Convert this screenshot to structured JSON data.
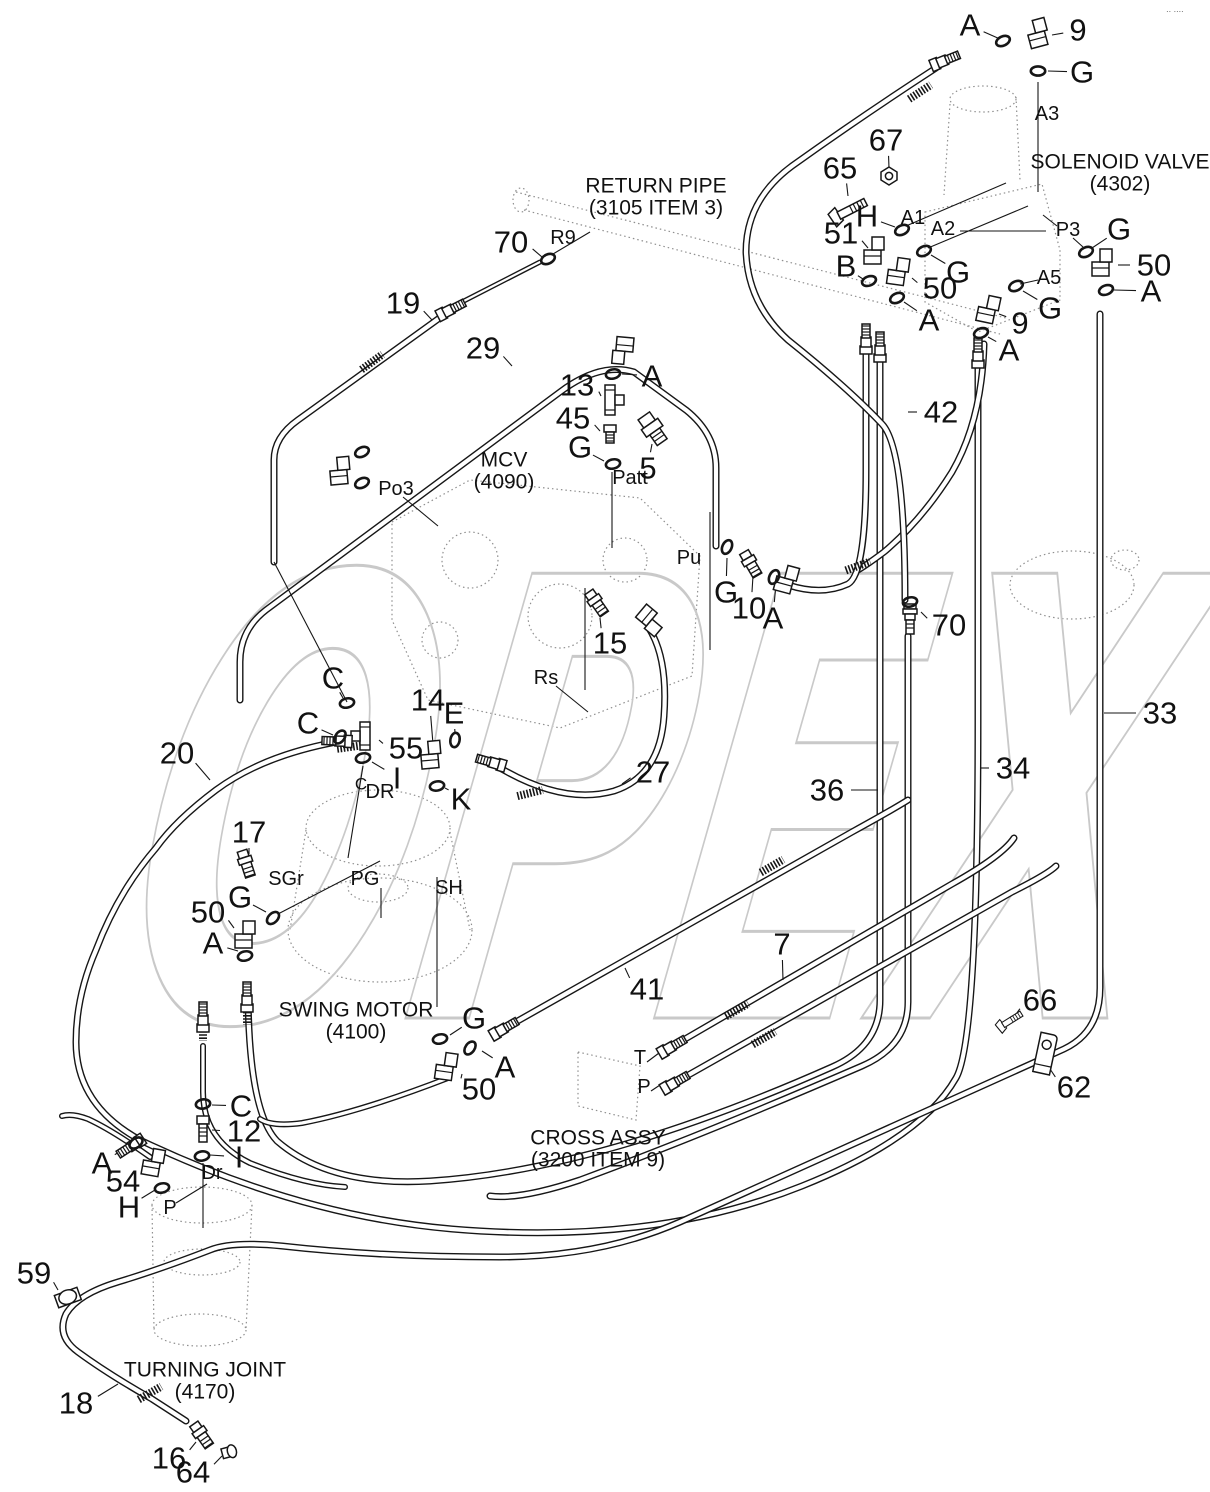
{
  "watermark": {
    "text": "OPEX",
    "color": "#c9c9c9"
  },
  "corner_mark": "∙∙ ∙∙∙∙",
  "colors": {
    "line": "#161616",
    "label": "#111111",
    "ghost": "#8f8f8f",
    "white": "#ffffff"
  },
  "titles": [
    {
      "id": "return-pipe",
      "lines": [
        "RETURN PIPE",
        "(3105 ITEM 3)"
      ],
      "x": 656,
      "y": 186
    },
    {
      "id": "solenoid-valve",
      "lines": [
        "SOLENOID VALVE",
        "(4302)"
      ],
      "x": 1120,
      "y": 162
    },
    {
      "id": "mcv",
      "lines": [
        "MCV",
        "(4090)"
      ],
      "x": 504,
      "y": 460
    },
    {
      "id": "swing-motor",
      "lines": [
        "SWING MOTOR",
        "(4100)"
      ],
      "x": 356,
      "y": 1010
    },
    {
      "id": "cross-assy",
      "lines": [
        "CROSS ASSY",
        "(3200 ITEM 9)"
      ],
      "x": 598,
      "y": 1138
    },
    {
      "id": "turning-joint",
      "lines": [
        "TURNING JOINT",
        "(4170)"
      ],
      "x": 205,
      "y": 1370
    }
  ],
  "callouts": [
    {
      "t": "A",
      "x": 970,
      "y": 25,
      "ex": 1000,
      "ey": 39
    },
    {
      "t": "9",
      "x": 1078,
      "y": 30,
      "ex": 1052,
      "ey": 35
    },
    {
      "t": "G",
      "x": 1082,
      "y": 72,
      "ex": 1048,
      "ey": 71
    },
    {
      "t": "67",
      "x": 886,
      "y": 140,
      "ex": 889,
      "ey": 168
    },
    {
      "t": "65",
      "x": 840,
      "y": 168,
      "ex": 848,
      "ey": 196
    },
    {
      "t": "H",
      "x": 867,
      "y": 216,
      "ex": 895,
      "ey": 227
    },
    {
      "t": "51",
      "x": 841,
      "y": 233,
      "ex": 868,
      "ey": 248
    },
    {
      "t": "B",
      "x": 846,
      "y": 266,
      "ex": 863,
      "ey": 279
    },
    {
      "t": "50",
      "x": 940,
      "y": 288,
      "ex": 912,
      "ey": 278
    },
    {
      "t": "G",
      "x": 958,
      "y": 272,
      "ex": 931,
      "ey": 255
    },
    {
      "t": "A",
      "x": 929,
      "y": 320,
      "ex": 904,
      "ey": 302
    },
    {
      "t": "9",
      "x": 1020,
      "y": 323,
      "ex": 999,
      "ey": 314
    },
    {
      "t": "G",
      "x": 1050,
      "y": 308,
      "ex": 1023,
      "ey": 291
    },
    {
      "t": "A",
      "x": 1009,
      "y": 350,
      "ex": 988,
      "ey": 337
    },
    {
      "t": "G",
      "x": 1119,
      "y": 229,
      "ex": 1092,
      "ey": 248
    },
    {
      "t": "50",
      "x": 1154,
      "y": 265,
      "ex": 1118,
      "ey": 265
    },
    {
      "t": "A",
      "x": 1151,
      "y": 291,
      "ex": 1114,
      "ey": 290
    },
    {
      "t": "70",
      "x": 511,
      "y": 242,
      "ex": 542,
      "ey": 257
    },
    {
      "t": "19",
      "x": 403,
      "y": 303,
      "ex": 432,
      "ey": 320
    },
    {
      "t": "29",
      "x": 483,
      "y": 348,
      "ex": 512,
      "ey": 366
    },
    {
      "t": "A",
      "x": 652,
      "y": 376,
      "ex": 622,
      "ey": 374
    },
    {
      "t": "13",
      "x": 577,
      "y": 385,
      "ex": 601,
      "ey": 396
    },
    {
      "t": "45",
      "x": 573,
      "y": 418,
      "ex": 600,
      "ey": 431
    },
    {
      "t": "G",
      "x": 580,
      "y": 447,
      "ex": 604,
      "ey": 461
    },
    {
      "t": "5",
      "x": 648,
      "y": 468,
      "ex": 652,
      "ey": 444
    },
    {
      "t": "15",
      "x": 610,
      "y": 643,
      "ex": 600,
      "ey": 618
    },
    {
      "t": "G",
      "x": 726,
      "y": 592,
      "ex": 727,
      "ey": 558
    },
    {
      "t": "10",
      "x": 749,
      "y": 608,
      "ex": 753,
      "ey": 576
    },
    {
      "t": "A",
      "x": 773,
      "y": 618,
      "ex": 776,
      "ey": 584
    },
    {
      "t": "70",
      "x": 949,
      "y": 625,
      "ex": 921,
      "ey": 612
    },
    {
      "t": "42",
      "x": 941,
      "y": 412,
      "ex": 908,
      "ey": 412
    },
    {
      "t": "33",
      "x": 1160,
      "y": 713,
      "ex": 1104,
      "ey": 713
    },
    {
      "t": "34",
      "x": 1013,
      "y": 768,
      "ex": 980,
      "ey": 768
    },
    {
      "t": "36",
      "x": 827,
      "y": 790,
      "ex": 878,
      "ey": 790
    },
    {
      "t": "C",
      "x": 333,
      "y": 678,
      "ex": 343,
      "ey": 698
    },
    {
      "t": "C",
      "x": 308,
      "y": 723,
      "ex": 333,
      "ey": 735
    },
    {
      "t": "20",
      "x": 177,
      "y": 753,
      "ex": 210,
      "ey": 780
    },
    {
      "t": "55",
      "x": 406,
      "y": 748,
      "ex": 379,
      "ey": 740
    },
    {
      "t": "14",
      "x": 428,
      "y": 700,
      "ex": 433,
      "ey": 744
    },
    {
      "t": "E",
      "x": 454,
      "y": 713,
      "ex": 455,
      "ey": 733
    },
    {
      "t": "I",
      "x": 397,
      "y": 778,
      "ex": 372,
      "ey": 762
    },
    {
      "t": "K",
      "x": 461,
      "y": 799,
      "ex": 445,
      "ey": 788
    },
    {
      "t": "27",
      "x": 653,
      "y": 772,
      "ex": 622,
      "ey": 784
    },
    {
      "t": "17",
      "x": 249,
      "y": 832,
      "ex": 249,
      "ey": 854
    },
    {
      "t": "G",
      "x": 240,
      "y": 897,
      "ex": 266,
      "ey": 912
    },
    {
      "t": "50",
      "x": 208,
      "y": 912,
      "ex": 234,
      "ey": 928
    },
    {
      "t": "A",
      "x": 213,
      "y": 943,
      "ex": 238,
      "ey": 951
    },
    {
      "t": "G",
      "x": 474,
      "y": 1018,
      "ex": 450,
      "ey": 1035
    },
    {
      "t": "A",
      "x": 505,
      "y": 1067,
      "ex": 482,
      "ey": 1051
    },
    {
      "t": "50",
      "x": 479,
      "y": 1089,
      "ex": 462,
      "ey": 1074
    },
    {
      "t": "41",
      "x": 647,
      "y": 989,
      "ex": 625,
      "ey": 968
    },
    {
      "t": "7",
      "x": 782,
      "y": 944,
      "ex": 783,
      "ey": 980
    },
    {
      "t": "66",
      "x": 1040,
      "y": 1000,
      "ex": 1014,
      "ey": 1017
    },
    {
      "t": "62",
      "x": 1074,
      "y": 1087,
      "ex": 1048,
      "ey": 1066
    },
    {
      "t": "C",
      "x": 241,
      "y": 1106,
      "ex": 212,
      "ey": 1105
    },
    {
      "t": "12",
      "x": 244,
      "y": 1131,
      "ex": 212,
      "ey": 1130
    },
    {
      "t": "I",
      "x": 239,
      "y": 1157,
      "ex": 210,
      "ey": 1155
    },
    {
      "t": "A",
      "x": 102,
      "y": 1163,
      "ex": 128,
      "ey": 1147
    },
    {
      "t": "54",
      "x": 123,
      "y": 1181,
      "ex": 146,
      "ey": 1166
    },
    {
      "t": "H",
      "x": 129,
      "y": 1207,
      "ex": 155,
      "ey": 1190
    },
    {
      "t": "59",
      "x": 34,
      "y": 1273,
      "ex": 58,
      "ey": 1290
    },
    {
      "t": "18",
      "x": 76,
      "y": 1403,
      "ex": 118,
      "ey": 1384
    },
    {
      "t": "16",
      "x": 169,
      "y": 1458,
      "ex": 196,
      "ey": 1442
    },
    {
      "t": "64",
      "x": 193,
      "y": 1472,
      "ex": 222,
      "ey": 1456
    }
  ],
  "ports": [
    {
      "t": "R9",
      "x": 563,
      "y": 238
    },
    {
      "t": "A3",
      "x": 1047,
      "y": 114
    },
    {
      "t": "A1",
      "x": 913,
      "y": 218
    },
    {
      "t": "A2",
      "x": 943,
      "y": 229
    },
    {
      "t": "A5",
      "x": 1049,
      "y": 278
    },
    {
      "t": "P3",
      "x": 1068,
      "y": 230
    },
    {
      "t": "Po3",
      "x": 396,
      "y": 489
    },
    {
      "t": "Patt",
      "x": 630,
      "y": 478
    },
    {
      "t": "Pu",
      "x": 689,
      "y": 558
    },
    {
      "t": "Rs",
      "x": 546,
      "y": 678
    },
    {
      "t": "SGr",
      "x": 286,
      "y": 879
    },
    {
      "t": "PG",
      "x": 365,
      "y": 879
    },
    {
      "t": "SH",
      "x": 449,
      "y": 888
    },
    {
      "t": "C",
      "x": 361,
      "y": 784,
      "s": 17
    },
    {
      "t": "DR",
      "x": 380,
      "y": 792
    },
    {
      "t": "Dr",
      "x": 212,
      "y": 1173
    },
    {
      "t": "P",
      "x": 170,
      "y": 1208
    },
    {
      "t": "T",
      "x": 640,
      "y": 1058
    },
    {
      "t": "P",
      "x": 644,
      "y": 1087
    }
  ],
  "lines": [
    [
      1038,
      82,
      1038,
      192
    ],
    [
      906,
      226,
      1006,
      183
    ],
    [
      928,
      248,
      1028,
      206
    ],
    [
      960,
      231,
      1046,
      231
    ],
    [
      1020,
      284,
      1038,
      280
    ],
    [
      1073,
      238,
      1083,
      247
    ],
    [
      1057,
      226,
      1043,
      215
    ],
    [
      612,
      472,
      612,
      548
    ],
    [
      710,
      512,
      710,
      650
    ],
    [
      585,
      588,
      585,
      690
    ],
    [
      556,
      686,
      588,
      712
    ],
    [
      437,
      877,
      437,
      1007
    ],
    [
      381,
      888,
      381,
      918
    ],
    [
      278,
      914,
      380,
      861
    ],
    [
      363,
      766,
      348,
      858
    ],
    [
      203,
      1163,
      203,
      1228
    ],
    [
      176,
      1203,
      207,
      1184
    ],
    [
      274,
      562,
      347,
      702
    ],
    [
      403,
      497,
      438,
      526
    ],
    [
      553,
      254,
      590,
      232
    ],
    [
      647,
      1062,
      659,
      1053
    ],
    [
      651,
      1091,
      663,
      1083
    ]
  ],
  "hoses": [
    {
      "d": "M336,742 Q262,756 216,790 Q176,820 156,848 Q118,892 96,950 Q76,996 76,1042 Q76,1106 142,1141 Q300,1216 452,1229 Q652,1246 802,1186 Q922,1138 956,1078 Q978,1040 978,720 L978,354",
      "w": 7
    },
    {
      "d": "M880,350 L880,1000 Q880,1046 832,1067 Q600,1170 430,1181 Q330,1187 277,1141 Q249,1112 248,994",
      "w": 7
    },
    {
      "d": "M908,636 L908,1002 Q908,1046 862,1066 Q700,1136 580,1180 Q520,1200 490,1196",
      "w": 7
    },
    {
      "d": "M984,344 Q982,420 952,472 Q922,520 884,552 Q868,564 858,570",
      "w": 7
    },
    {
      "d": "M788,585 Q822,596 848,584 Q866,574 866,470 L866,344",
      "w": 7
    },
    {
      "d": "M936,68 Q862,116 792,166 Q746,200 746,252 Q748,304 788,340 Q848,388 882,424 Q905,448 905,600",
      "w": 7
    },
    {
      "d": "M1100,314 L1100,988 Q1100,1032 1064,1049 L680,1222 Q600,1257 500,1257 Q380,1257 282,1246 Q232,1241 210,1250 Q158,1270 118,1282 Q78,1294 66,1314 Q56,1336 78,1352 Q108,1374 152,1399 L186,1421",
      "w": 7
    },
    {
      "d": "M203,1046 L203,1092 Q203,1140 250,1163 Q305,1185 345,1187",
      "w": 6
    },
    {
      "d": "M448,1078 Q360,1112 302,1123 Q272,1127 260,1119",
      "w": 6
    },
    {
      "d": "M150,1157 Q112,1130 88,1119 Q72,1113 62,1116",
      "w": 6
    },
    {
      "d": "M240,700 L240,662 Q240,630 266,610 L560,392 Q600,362 634,372 L686,410 Q716,434 716,468 L716,546",
      "w": 7
    },
    {
      "d": "M452,309 L298,420 Q274,437 274,460 L274,562",
      "w": 7
    },
    {
      "d": "M458,304 L540,262",
      "w": 5
    },
    {
      "d": "M492,763 Q560,806 614,791 Q660,776 664,716 Q668,660 650,630",
      "w": 7
    },
    {
      "d": "M507,1027 L852,832 Q892,810 908,800",
      "w": 7
    },
    {
      "d": "M673,1046 L952,884 Q1002,856 1014,838",
      "w": 7
    },
    {
      "d": "M676,1082 L1012,892 Q1048,874 1056,866",
      "w": 7
    }
  ],
  "braids": [
    [
      372,
      362,
      -36
    ],
    [
      350,
      747,
      -8
    ],
    [
      920,
      92,
      -33
    ],
    [
      858,
      566,
      -20
    ],
    [
      772,
      866,
      -30
    ],
    [
      737,
      1010,
      -30
    ],
    [
      764,
      1038,
      -30
    ],
    [
      530,
      793,
      -14
    ],
    [
      150,
      1393,
      -30
    ],
    [
      247,
      1012,
      90
    ],
    [
      203,
      1028,
      90
    ]
  ],
  "orings": [
    [
      1003,
      41,
      -25
    ],
    [
      1038,
      71,
      0
    ],
    [
      902,
      230,
      -25
    ],
    [
      869,
      281,
      -20
    ],
    [
      924,
      251,
      -25
    ],
    [
      897,
      298,
      -25
    ],
    [
      1016,
      286,
      -25
    ],
    [
      981,
      333,
      -20
    ],
    [
      1086,
      252,
      -25
    ],
    [
      1106,
      290,
      -20
    ],
    [
      548,
      259,
      -25
    ],
    [
      613,
      374,
      -12
    ],
    [
      613,
      464,
      -12
    ],
    [
      727,
      547,
      -65
    ],
    [
      774,
      577,
      -65
    ],
    [
      910,
      602,
      -12
    ],
    [
      347,
      703,
      -12
    ],
    [
      340,
      737,
      -55
    ],
    [
      363,
      758,
      -12
    ],
    [
      455,
      740,
      -80
    ],
    [
      437,
      786,
      -10
    ],
    [
      362,
      452,
      -25
    ],
    [
      362,
      483,
      -25
    ],
    [
      273,
      918,
      -45
    ],
    [
      245,
      956,
      -12
    ],
    [
      440,
      1039,
      -12
    ],
    [
      470,
      1048,
      -55
    ],
    [
      203,
      1104,
      -8
    ],
    [
      202,
      1156,
      -8
    ],
    [
      136,
      1143,
      -35
    ],
    [
      162,
      1188,
      -12
    ]
  ],
  "parts": [
    [
      "elbow",
      1040,
      34,
      -15
    ],
    [
      "hosend",
      946,
      60,
      -22
    ],
    [
      "nut67",
      889,
      176,
      0
    ],
    [
      "bolt",
      846,
      212,
      -27,
      1
    ],
    [
      "elbow",
      876,
      252,
      0
    ],
    [
      "elbow",
      900,
      273,
      8
    ],
    [
      "elbow",
      990,
      311,
      12
    ],
    [
      "elbow",
      1104,
      264,
      0
    ],
    [
      "hosend",
      452,
      309,
      -27
    ],
    [
      "elbow",
      621,
      349,
      185
    ],
    [
      "tee13",
      610,
      400,
      0
    ],
    [
      "reducer45",
      610,
      434,
      0
    ],
    [
      "sensor5",
      653,
      429,
      -35
    ],
    [
      "elbow",
      342,
      472,
      -5
    ],
    [
      "straight",
      752,
      566,
      -30
    ],
    [
      "elbow",
      788,
      581,
      15
    ],
    [
      "hosetop",
      910,
      618,
      0
    ],
    [
      "hosend",
      866,
      338,
      -90
    ],
    [
      "hosend",
      880,
      346,
      -90
    ],
    [
      "hosend",
      978,
      352,
      -90
    ],
    [
      "tee55",
      365,
      736,
      0
    ],
    [
      "elbow",
      433,
      756,
      -5
    ],
    [
      "straight",
      598,
      605,
      -35
    ],
    [
      "elbow",
      648,
      621,
      130
    ],
    [
      "hosend",
      490,
      762,
      196
    ],
    [
      "hosend",
      336,
      741,
      182
    ],
    [
      "straight",
      247,
      866,
      -18
    ],
    [
      "elbow",
      247,
      936,
      0
    ],
    [
      "hosend",
      247,
      996,
      -90
    ],
    [
      "hosend",
      203,
      1016,
      -90
    ],
    [
      "adapter12",
      203,
      1130,
      0
    ],
    [
      "elbow",
      448,
      1068,
      8
    ],
    [
      "hosend",
      505,
      1028,
      -30
    ],
    [
      "hosend",
      673,
      1046,
      -30
    ],
    [
      "hosend",
      676,
      1082,
      -30
    ],
    [
      "elbow",
      155,
      1164,
      10
    ],
    [
      "hosend",
      130,
      1147,
      147
    ],
    [
      "bolt",
      1008,
      1022,
      -32,
      0.72
    ],
    [
      "bracket62",
      1042,
      1057,
      12
    ],
    [
      "clamp59",
      68,
      1298,
      -20
    ],
    [
      "straight",
      203,
      1437,
      -35
    ],
    [
      "plug64",
      229,
      1452,
      -15
    ]
  ],
  "ghost_ellipses": [
    [
      521,
      200,
      8,
      12
    ],
    [
      983,
      99,
      33,
      13
    ],
    [
      1072,
      585,
      62,
      34
    ],
    [
      1125,
      560,
      14,
      10
    ],
    [
      378,
      828,
      72,
      38
    ],
    [
      380,
      930,
      92,
      52
    ],
    [
      378,
      888,
      30,
      14
    ],
    [
      202,
      1205,
      50,
      18
    ],
    [
      202,
      1262,
      38,
      13
    ],
    [
      200,
      1330,
      46,
      16
    ],
    [
      470,
      560,
      28,
      28
    ],
    [
      560,
      616,
      32,
      32
    ],
    [
      625,
      560,
      22,
      22
    ],
    [
      440,
      640,
      18,
      18
    ]
  ],
  "ghost_paths": [
    "M516,192 L1006,318",
    "M524,210 L1000,334",
    "M950,104 L944,195",
    "M1016,97 L1020,180",
    "M925,212 L1042,184 L1060,250 L1060,300 L978,332 L925,302 Z",
    "M392,522 L470,480 L640,498 L700,556 L692,676 L560,728 L428,700 L392,620 Z",
    "M306,830 L290,930",
    "M450,832 L470,930",
    "M152,1205 L154,1330",
    "M252,1205 L246,1330",
    "M578,1052 L640,1066 L636,1120 L578,1106 Z"
  ]
}
